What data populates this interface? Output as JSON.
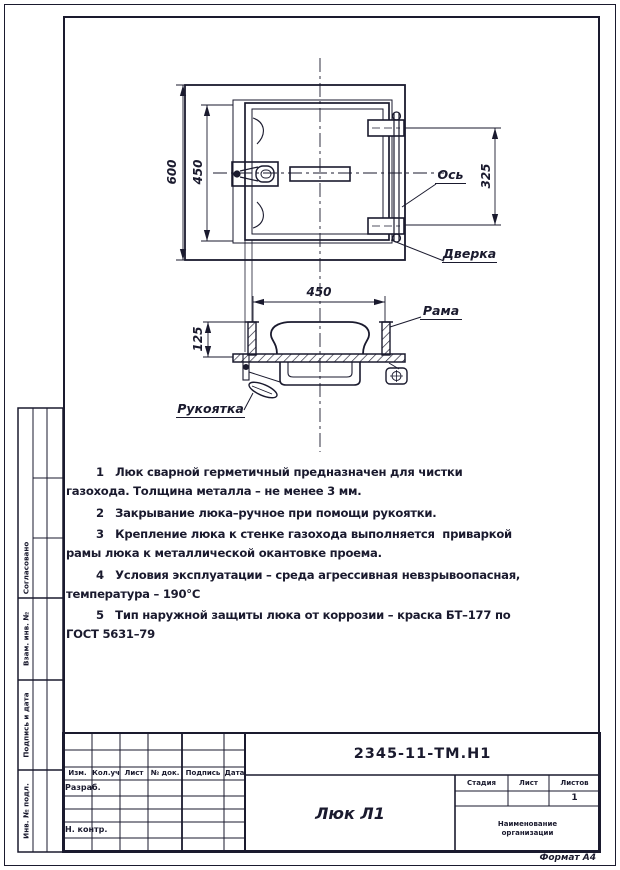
{
  "colors": {
    "ink": "#1a1a2e",
    "paper": "#ffffff"
  },
  "views": {
    "top": {
      "dim_600": "600",
      "dim_450": "450",
      "dim_325": "325",
      "label_axis": "Ось",
      "label_door": "Дверка"
    },
    "section": {
      "dim_450": "450",
      "dim_125": "125",
      "label_frame": "Рама",
      "label_handle": "Рукоятка"
    }
  },
  "notes": [
    "1   Люк сварной герметичный предназначен для чистки газохода. Толщина металла – не менее 3 мм.",
    "2   Закрывание люка–ручное при помощи рукоятки.",
    "3   Крепление люка к стенке газохода выполняется  приваркой рамы люка к металлической окантовке проема.",
    "4   Условия эксплуатации – среда агрессивная невзрывоопасная, температура – 190°С",
    "5   Тип наружной защиты люка от коррозии – краска БТ–177 по ГОСТ 5631–79"
  ],
  "title_block": {
    "doc_number": "2345-11-ТМ.Н1",
    "title": "Люк Л1",
    "rev_headers": [
      "Изм.",
      "Кол.уч",
      "Лист",
      "№ док.",
      "Подпись",
      "Дата"
    ],
    "staff": {
      "developed": "Разраб.",
      "checked": "Н. контр."
    },
    "right_headers": [
      "Стадия",
      "Лист",
      "Листов"
    ],
    "sheets_total": "1",
    "org_line1": "Наименование",
    "org_line2": "организации"
  },
  "side_stamps": [
    "Согласовано",
    "Взам. инв. №",
    "Подпись и дата",
    "Инв. № подл."
  ],
  "footer": {
    "format": "Формат А4"
  }
}
